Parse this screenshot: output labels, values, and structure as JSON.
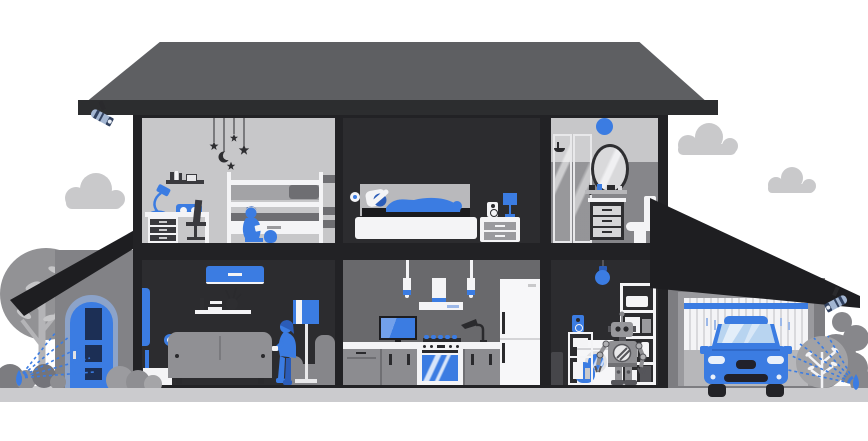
{
  "title": "smart-home-cutaway-illustration",
  "palette": {
    "blue": "#3b7ce2",
    "blue_dark": "#2b5cb8",
    "navy": "#1c2f55",
    "steel": "#a3b6d2",
    "roof": "#5e5f62",
    "roof_dark": "#1e1e21",
    "fascia": "#2c2d2f",
    "wall": "#222225",
    "room_dark": "#2c2c2f",
    "room_light": "#c7c7c9",
    "room_mid": "#86868a",
    "kitchen_wall": "#69696c",
    "porch_wall": "#828286",
    "garage_wall": "#7d7d81",
    "gray": "#909094",
    "gray_mid": "#6e6e72",
    "ink": "#2e2e31",
    "white": "#f4f4f6",
    "ground": "#cbcbce",
    "cloud": "#c9c9cb",
    "tree": "#929295",
    "trunk": "#b4b4b7",
    "bush": "#85858a",
    "glass": "#b8d4f0"
  },
  "rooms": [
    {
      "id": "kids-room",
      "floor": "upper",
      "objects": [
        "star-moon-mobile",
        "wall-shelf-books",
        "desk-lamp",
        "smart-speaker-box",
        "desk-with-drawers",
        "office-chair",
        "bunk-bed",
        "ladder-shelf",
        "child-with-tablet",
        "toy"
      ]
    },
    {
      "id": "bedroom",
      "floor": "upper",
      "objects": [
        "smart-sensor-dot",
        "bed-with-sleeping-person",
        "nightstand",
        "speaker",
        "bedside-lamp"
      ]
    },
    {
      "id": "bathroom",
      "floor": "upper",
      "objects": [
        "smart-light-dot",
        "shower-cabin",
        "oval-mirror",
        "toiletry-shelf",
        "vanity-cabinet",
        "toilet"
      ]
    },
    {
      "id": "living-room",
      "floor": "ground",
      "objects": [
        "air-conditioner",
        "wall-shelf",
        "vase-with-twigs",
        "smart-button",
        "sofa",
        "floor-lamp",
        "armchair",
        "woman-with-phone",
        "vacuum-dock"
      ]
    },
    {
      "id": "kitchen",
      "floor": "ground",
      "objects": [
        "pendant-lamp-left",
        "pendant-lamp-right",
        "range-hood",
        "tv",
        "gas-burners",
        "oven-stove",
        "faucet",
        "counter-cabinets",
        "fridge"
      ]
    },
    {
      "id": "utility-room",
      "floor": "ground",
      "objects": [
        "smart-bulb",
        "storage-shelf-unit",
        "washing-machine",
        "laundry-pile",
        "robot-assistant",
        "speaker",
        "small-cabinet",
        "trash-bin"
      ]
    },
    {
      "id": "garage",
      "floor": "ground",
      "objects": [
        "garage-door",
        "car",
        "security-camera"
      ]
    }
  ],
  "outdoor": {
    "left": [
      "cloud",
      "security-camera",
      "tree",
      "porch-roof",
      "front-door",
      "bushes",
      "lawn-sprinkler"
    ],
    "right": [
      "cloud",
      "cloud",
      "garage-roof",
      "round-bush",
      "bush-silhouette",
      "lawn-sprinkler"
    ]
  }
}
